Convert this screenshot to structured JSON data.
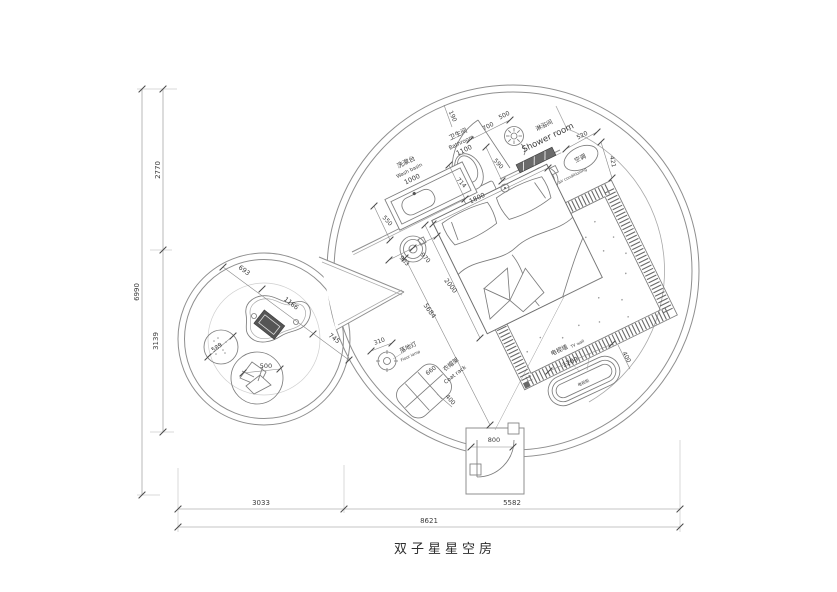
{
  "title": "双子星星空房",
  "rooms": {
    "washbasin_cn": "洗漱台",
    "washbasin_en": "Wash basin",
    "bathroom_cn": "卫生间",
    "bathroom_en": "Bathroom",
    "shower_cn": "淋浴间",
    "shower_en": "Shower room",
    "ac_cn": "空调",
    "ac_en": "air conditioning",
    "floor_lamp_cn": "落地灯",
    "floor_lamp_en": "Floor lamp",
    "coat_rack_cn": "衣帽架",
    "coat_rack_en": "Coat rack",
    "tv_wall_cn": "电视墙",
    "tv_wall_en": "TV wall",
    "tv_cabinet_cn": "电视柜"
  },
  "dims": {
    "overall_width": "8621",
    "bottom_left": "3033",
    "bottom_right": "5582",
    "overall_height": "6990",
    "left_upper": "2770",
    "left_lower": "3139",
    "washbasin_len": "1000",
    "washbasin_side": "550",
    "bathroom_len": "1100",
    "wall_end": "190",
    "bath_wall": "700",
    "bath_door": "500",
    "shower_side": "520",
    "shower_depth": "421",
    "toilet_side": "590",
    "toilet_off": "714",
    "bed_width": "1800",
    "bed_len": "2000",
    "bed_off1": "963",
    "bed_off2": "970",
    "room_diag": "5684",
    "lamp_dia": "310",
    "coat_len": "660",
    "coat_dep": "400",
    "tv_len": "1200",
    "tv_dep": "400",
    "entry_door": "800",
    "lounge_off": "693",
    "lounge_table": "1166",
    "lounge_gap": "745",
    "stool_dia": "589",
    "seat_dia": "500"
  }
}
